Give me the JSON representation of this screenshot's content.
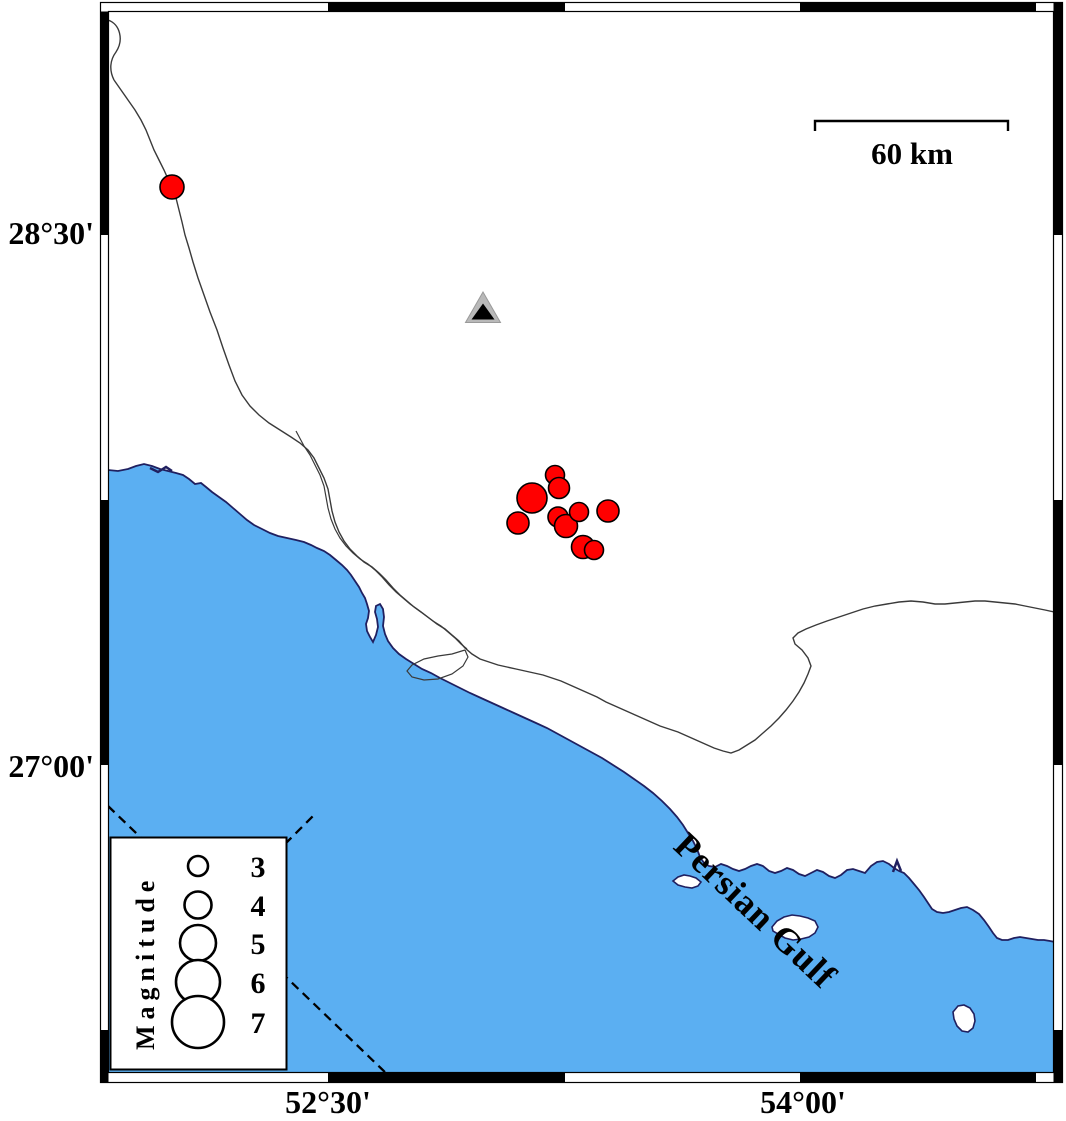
{
  "frame": {
    "left_axis": [
      {
        "label": "28°30'"
      },
      {
        "label": "27°00'"
      }
    ],
    "bottom_axis": [
      {
        "label": "52°30'"
      },
      {
        "label": "54°00'"
      }
    ]
  },
  "scale_bar": {
    "label": "60 km"
  },
  "sea": {
    "label": "Persian Gulf"
  },
  "legend": {
    "title": "Magnitude",
    "entries": [
      {
        "label": "3",
        "r": 10,
        "cy": 866
      },
      {
        "label": "4",
        "r": 13.5,
        "cy": 905
      },
      {
        "label": "5",
        "r": 18,
        "cy": 943
      },
      {
        "label": "6",
        "r": 22,
        "cy": 982
      },
      {
        "label": "7",
        "r": 26,
        "cy": 1022
      }
    ]
  },
  "station": {
    "type": "seismic-station-triangle",
    "x": 483,
    "y": 309
  },
  "earthquakes": [
    {
      "x": 172,
      "y": 187,
      "r": 12,
      "mag": 3.5
    },
    {
      "x": 532,
      "y": 498,
      "r": 15,
      "mag": 4.3
    },
    {
      "x": 555,
      "y": 475,
      "r": 9.5,
      "mag": 2.9
    },
    {
      "x": 559,
      "y": 488,
      "r": 10.5,
      "mag": 3.1
    },
    {
      "x": 518,
      "y": 523,
      "r": 11,
      "mag": 3.3
    },
    {
      "x": 558,
      "y": 517,
      "r": 10,
      "mag": 3.0
    },
    {
      "x": 566,
      "y": 526,
      "r": 11.5,
      "mag": 3.4
    },
    {
      "x": 579,
      "y": 512,
      "r": 9.5,
      "mag": 2.9
    },
    {
      "x": 608,
      "y": 511,
      "r": 11,
      "mag": 3.3
    },
    {
      "x": 583,
      "y": 547,
      "r": 11.5,
      "mag": 3.4
    },
    {
      "x": 594,
      "y": 550,
      "r": 9.5,
      "mag": 2.9
    }
  ],
  "colors": {
    "water": "#5BAFF2",
    "coast": "#202060",
    "earthquake": "#FF0000",
    "station_outer": "#B9B9B9",
    "station_inner": "#000000",
    "land": "#FFFFFF"
  }
}
